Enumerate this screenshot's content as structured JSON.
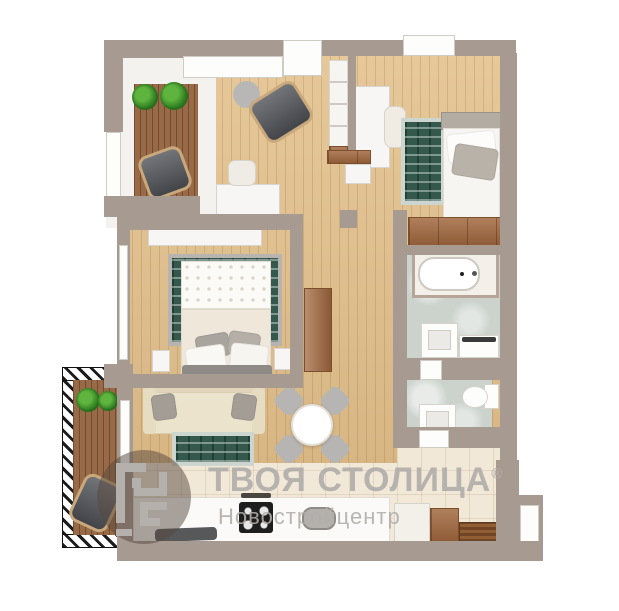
{
  "watermark": {
    "brand": "ТВОЯ СТОЛИЦА",
    "registered_mark": "®",
    "subtitle": "Новостройцентр"
  },
  "palette": {
    "wall": "#a79a90",
    "wood_floor": "#e3c08b",
    "deck_wood": "#996a47",
    "tile": "#f1e8d7",
    "marble": "#ccd3cd",
    "rug_green": "#35584c",
    "rug_border": "#ccd5cf",
    "sofa": "#ece3cd",
    "gray_furniture": "#53565b",
    "door_wood": "#a2683e",
    "watermark_gray": "#b2aeab"
  }
}
